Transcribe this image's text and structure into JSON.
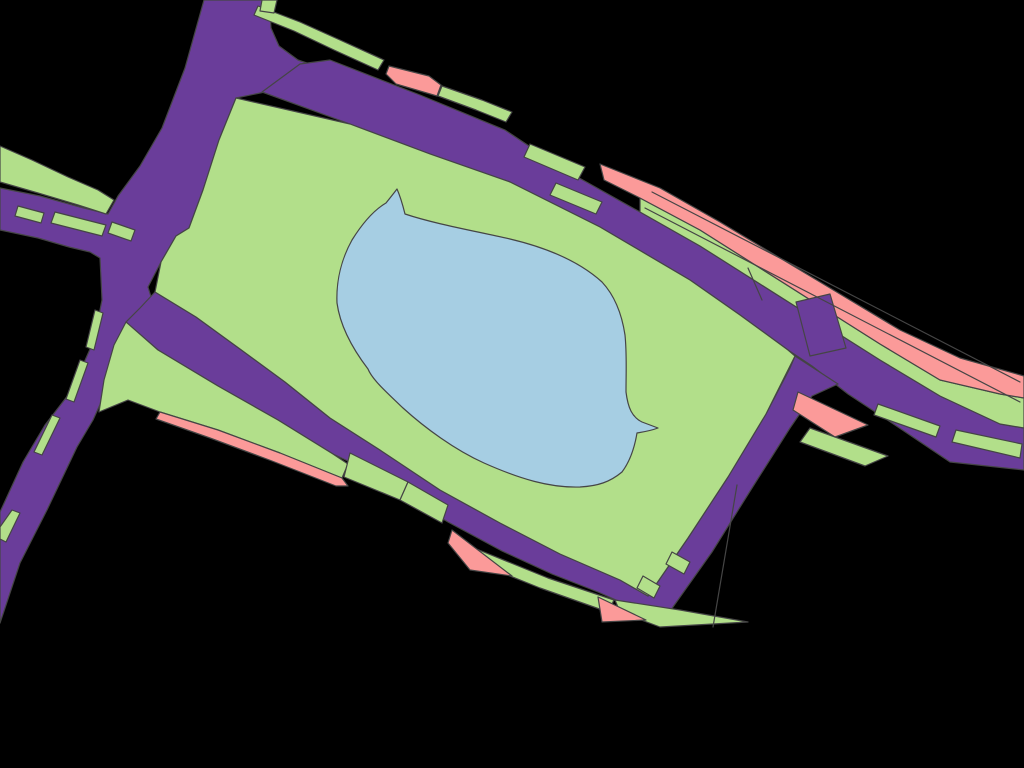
{
  "map": {
    "background": "#000000",
    "stroke_color": "#454545",
    "stroke_width": 1.2,
    "viewbox": "0 0 1024 768",
    "palette": {
      "road": "#6a3d9a",
      "grass": "#b2df8a",
      "water": "#a6cee3",
      "residential": "#fb9a99"
    },
    "shapes": [
      {
        "name": "road-trunk-junction",
        "fill": "road",
        "d": "M 204,0 L 269,0 L 271,28 L 279,46 L 298,60 L 342,75 L 300,86 L 265,92 L 236,98 L 219,140 L 203,190 L 189,228 L 176,236 L 161,262 L 148,287 L 152,300 L 130,340 L 112,378 L 93,420 L 77,447 L 47,510 L 20,563 L 0,623 L 0,512 L 23,462 L 45,425 L 72,390 L 94,340 L 102,300 L 100,258 L 90,252 L 69,247 L 38,238 L 0,230 L 0,188 L 40,196 L 80,207 L 108,214 L 118,196 L 140,166 L 162,128 L 185,68 Z"
      },
      {
        "name": "road-top-boulevard",
        "fill": "road",
        "d": "M 262,92 L 300,64 L 330,60 L 420,95 L 505,130 L 565,170 L 640,212 L 700,246 L 760,284 L 820,322 L 880,360 L 940,396 L 1000,424 L 1024,428 L 1024,470 L 950,462 L 895,425 L 848,394 L 812,366 L 788,350 L 740,315 L 690,280 L 600,227 L 510,182 L 430,154 L 350,124 Z"
      },
      {
        "name": "road-park-ring",
        "fill": "road",
        "d": "M 140,308 L 155,292 L 196,317 L 240,349 L 285,382 L 330,418 L 380,450 L 440,490 L 500,523 L 560,554 L 620,580 L 648,596 L 688,538 L 728,477 L 766,414 L 790,368 L 795,356 L 838,384 L 812,396 L 790,428 L 752,488 L 712,552 L 668,614 L 654,620 L 634,608 L 598,592 L 552,574 L 502,551 L 448,522 L 394,490 L 350,462 L 333,454 L 278,420 L 218,386 L 158,350 L 126,322 Z"
      },
      {
        "name": "grass-left-edge-strip",
        "fill": "grass",
        "d": "M 0,146 L 32,160 L 68,177 L 98,190 L 114,200 L 106,214 L 78,205 L 38,193 L 0,182 Z"
      },
      {
        "name": "grass-top-strip",
        "fill": "grass",
        "d": "M 258,6 L 300,22 L 340,40 L 384,60 L 378,70 L 334,50 L 294,31 L 254,15 Z"
      },
      {
        "name": "grass-top-notch",
        "fill": "grass",
        "d": "M 262,0 L 277,0 L 274,13 L 260,11 Z"
      },
      {
        "name": "grass-top-strip-2",
        "fill": "grass",
        "d": "M 442,86 L 482,100 L 512,112 L 506,122 L 476,110 L 438,96 Z"
      },
      {
        "name": "park-main",
        "fill": "grass",
        "d": "M 236,98 L 350,124 L 430,154 L 510,182 L 600,227 L 690,280 L 740,315 L 788,350 L 795,356 L 766,414 L 728,477 L 688,538 L 648,596 L 620,580 L 560,554 L 500,523 L 440,490 L 380,450 L 330,418 L 285,382 L 240,349 L 196,317 L 155,292 L 161,262 L 176,236 L 189,228 L 203,190 L 219,140 Z"
      },
      {
        "name": "grass-southwest-wedge",
        "fill": "grass",
        "d": "M 126,322 L 158,350 L 218,386 L 278,420 L 333,454 L 348,464 L 342,478 L 280,453 L 218,430 L 160,412 L 128,400 L 99,412 L 104,380 L 114,345 Z"
      },
      {
        "name": "grass-parcel-south-a",
        "fill": "grass",
        "d": "M 350,453 L 408,482 L 400,500 L 344,477 Z"
      },
      {
        "name": "grass-parcel-south-b",
        "fill": "grass",
        "d": "M 408,482 L 448,505 L 442,523 L 400,500 Z"
      },
      {
        "name": "grass-south-strip",
        "fill": "grass",
        "d": "M 474,548 L 548,578 L 614,600 L 608,612 L 540,588 L 470,560 Z"
      },
      {
        "name": "grass-south-tip",
        "fill": "grass",
        "d": "M 615,600 L 680,610 L 748,622 L 660,627 L 620,612 Z"
      },
      {
        "name": "grass-ne-piece-1",
        "fill": "grass",
        "d": "M 530,144 L 585,167 L 578,180 L 524,157 Z"
      },
      {
        "name": "grass-ne-piece-2",
        "fill": "grass",
        "d": "M 556,183 L 602,202 L 596,214 L 550,195 Z"
      },
      {
        "name": "grass-ne-band",
        "fill": "grass",
        "d": "M 640,198 L 700,230 L 760,268 L 820,306 L 880,344 L 940,380 L 1000,394 L 1024,398 L 1024,428 L 1000,424 L 940,396 L 880,360 L 820,322 L 760,284 L 700,246 L 640,212 Z"
      },
      {
        "name": "grass-dash-junction-1",
        "fill": "grass",
        "d": "M 18,206 L 44,213 L 41,223 L 15,216 Z"
      },
      {
        "name": "grass-dash-junction-2",
        "fill": "grass",
        "d": "M 55,212 L 106,225 L 102,236 L 51,223 Z"
      },
      {
        "name": "grass-dash-junction-3",
        "fill": "grass",
        "d": "M 112,222 L 135,230 L 131,241 L 108,233 Z"
      },
      {
        "name": "grass-dash-west-1",
        "fill": "grass",
        "d": "M 95,310 L 103,313 L 94,350 L 86,347 Z"
      },
      {
        "name": "grass-dash-west-2",
        "fill": "grass",
        "d": "M 80,360 L 88,363 L 74,402 L 66,399 Z"
      },
      {
        "name": "grass-dash-west-3",
        "fill": "grass",
        "d": "M 52,415 L 60,418 L 42,455 L 34,452 Z"
      },
      {
        "name": "grass-dash-west-4",
        "fill": "grass",
        "d": "M 12,510 L 20,513 L 6,542 L 0,539 L 0,527 Z"
      },
      {
        "name": "grass-dash-branch-1",
        "fill": "grass",
        "d": "M 672,552 L 690,562 L 684,574 L 666,564 Z"
      },
      {
        "name": "grass-dash-branch-2",
        "fill": "grass",
        "d": "M 643,576 L 660,586 L 654,598 L 637,588 Z"
      },
      {
        "name": "grass-dash-se-1",
        "fill": "grass",
        "d": "M 878,404 L 940,426 L 936,437 L 874,415 Z"
      },
      {
        "name": "grass-dash-se-2",
        "fill": "grass",
        "d": "M 956,430 L 1022,444 L 1020,458 L 952,442 Z"
      },
      {
        "name": "grass-t-junction-wedge",
        "fill": "grass",
        "d": "M 810,428 L 888,456 L 865,466 L 800,442 Z"
      },
      {
        "name": "residential-top-parcel",
        "fill": "residential",
        "d": "M 389,66 L 429,76 L 441,85 L 437,96 L 396,84 L 386,74 Z"
      },
      {
        "name": "residential-ne-strip",
        "fill": "residential",
        "d": "M 600,164 L 660,188 L 720,222 L 780,258 L 840,294 L 900,330 L 960,358 L 1024,376 L 1024,398 L 1000,394 L 940,380 L 880,344 L 820,306 L 760,268 L 700,230 L 640,198 L 604,180 Z"
      },
      {
        "name": "residential-sw-strip",
        "fill": "residential",
        "d": "M 160,412 L 218,430 L 280,453 L 342,478 L 348,486 L 336,486 L 272,461 L 210,438 L 156,419 Z"
      },
      {
        "name": "residential-south-wedge",
        "fill": "residential",
        "d": "M 452,530 L 512,576 L 470,570 L 448,543 Z"
      },
      {
        "name": "residential-tip-sliver",
        "fill": "residential",
        "d": "M 598,597 L 646,620 L 602,622 Z"
      },
      {
        "name": "residential-t-wedge",
        "fill": "residential",
        "d": "M 798,392 L 868,425 L 835,437 L 793,410 Z"
      },
      {
        "name": "road-cross-stub",
        "fill": "road",
        "d": "M 796,302 L 830,294 L 846,348 L 810,356 Z"
      },
      {
        "name": "lake",
        "fill": "water",
        "d": "M 397,189 C 401,198 403,206 405,214 C 435,224 475,231 510,239 C 548,248 580,262 602,282 C 615,296 622,315 625,335 C 627,355 626,372 626,392 C 628,408 632,417 642,422 L 658,428 C 650,431 643,432 637,433 C 635,445 631,460 622,472 C 610,482 598,486 580,487 C 550,488 520,479 484,463 C 455,450 425,428 403,408 C 385,391 372,379 368,369 C 352,348 340,325 337,303 C 336,280 342,258 352,240 C 362,224 374,210 386,203 C 390,198 394,193 397,189 Z"
      },
      {
        "name": "seam-pink-strip",
        "fill": "none",
        "d": "M 652,192 L 1020,382"
      },
      {
        "name": "seam-green-band",
        "fill": "none",
        "d": "M 645,208 L 1020,402"
      },
      {
        "name": "seam-corridor-cross",
        "fill": "none",
        "d": "M 748,268 L 762,300"
      },
      {
        "name": "seam-tip-boundary",
        "fill": "none",
        "d": "M 737,485 L 713,627"
      }
    ]
  }
}
